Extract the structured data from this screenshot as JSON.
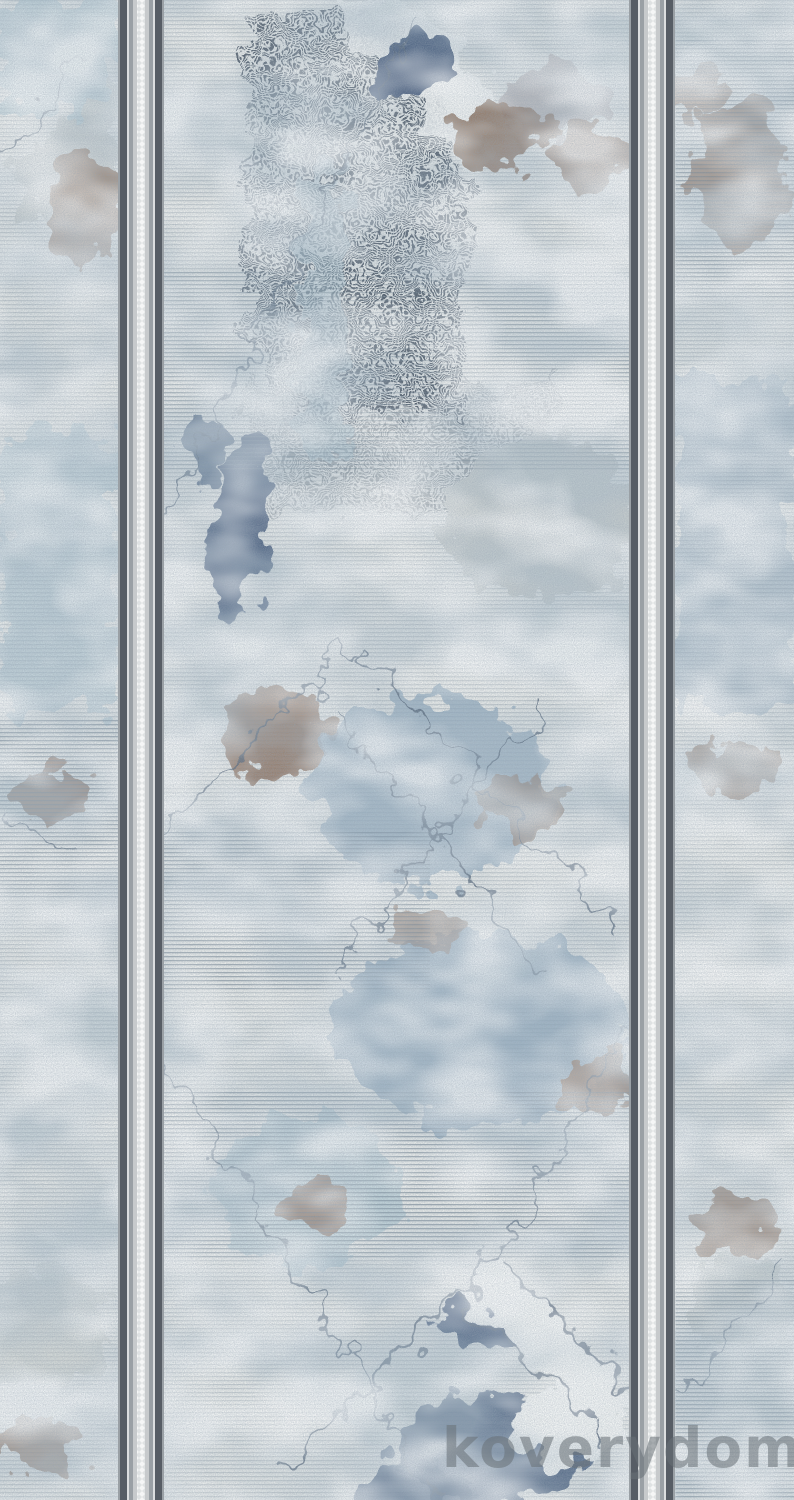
{
  "image": {
    "alt": "Distressed abstract runner carpet pattern in blue, gray and brown tones with two vertical guard stripe bands",
    "width_px": 794,
    "height_px": 1500
  },
  "watermark": {
    "text": "koverydom.ru",
    "color": "#687076"
  },
  "palette": {
    "base": "#e7eae8",
    "scanline": "#6b7d8c",
    "hatch_dark": "#3e4c5a",
    "navy": "#3a5173",
    "slate_line": "#46586d",
    "blue_wash": "#8fa8bc",
    "blue_wash_light": "#a9c3cf",
    "brown": "#8d7362",
    "gray_patch": "#c9cecd",
    "white_patch": "#f0f3f2",
    "stripe_dark": "#575d65",
    "stripe_mid": "#9aa0a5",
    "stripe_light": "#c7cacc",
    "stripe_pale": "#dcdedf",
    "stripe_white": "#f5f6f6"
  }
}
